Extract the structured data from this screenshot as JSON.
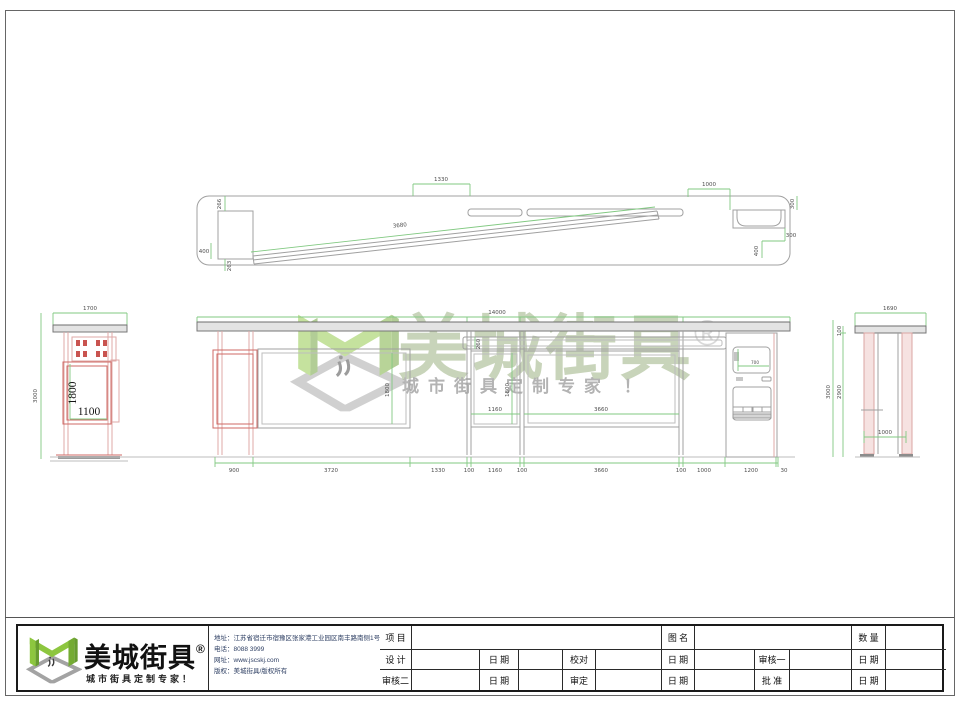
{
  "watermark": {
    "brand": "美城街具",
    "registered": "®",
    "tagline": "城市街具定制专家 ！"
  },
  "logo": {
    "brand": "美城街具",
    "registered": "®",
    "tagline": "城市街具定制专家！"
  },
  "company": {
    "address_label": "地址：",
    "address": "江苏省宿迁市宿豫区张家港工业园区南丰路南侧1号",
    "phone_label": "电话：",
    "phone": "8088 3999",
    "web_label": "网址：",
    "web": "www.jscskj.com",
    "copyright_label": "版权：",
    "copyright": "美城街具/版权所有"
  },
  "titleblock": {
    "project": "项 目",
    "drawing_name": "图 名",
    "quantity": "数 量",
    "design": "设 计",
    "date": "日 期",
    "proofread": "校对",
    "review1": "审核一",
    "review2": "审核二",
    "verify": "审定",
    "approve": "批 准"
  },
  "plan": {
    "d1330": "1330",
    "d1000": "1000",
    "d3680": "3680",
    "d266": "266",
    "d400l": "400",
    "d263": "263",
    "d300t": "300",
    "d300r": "300",
    "d400r": "400"
  },
  "left_view": {
    "d1700": "1700",
    "d3000": "3000",
    "d1800": "1800",
    "d1100": "1100"
  },
  "front_view": {
    "d14000": "14000",
    "d260": "260",
    "d1800a": "1800",
    "d1800b": "1800",
    "d1160": "1160",
    "d3660": "3660",
    "d700": "700",
    "bottom": [
      "900",
      "3720",
      "1330",
      "100",
      "1160",
      "100",
      "3660",
      "100",
      "1000",
      "1200",
      "30"
    ]
  },
  "right_view": {
    "d1690": "1690",
    "d100": "100",
    "d3000": "3000",
    "d2900": "2900",
    "d1000": "1000"
  }
}
